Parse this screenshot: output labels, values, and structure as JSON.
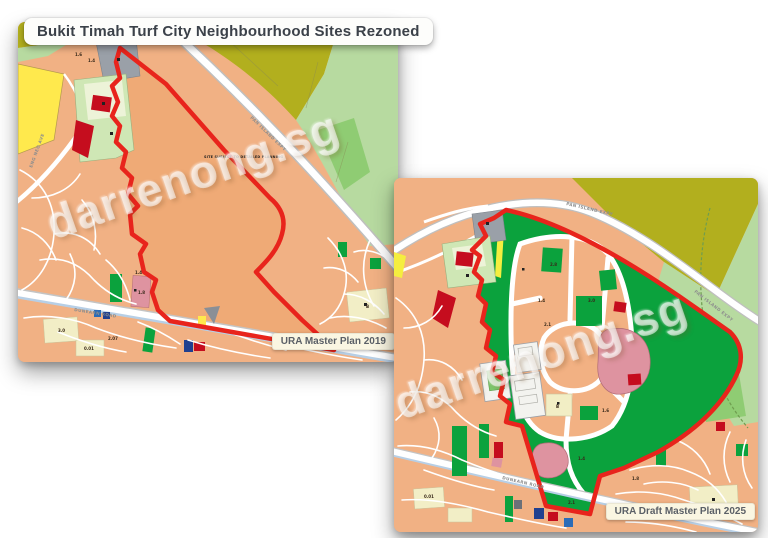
{
  "title": {
    "text": "Bukit Timah Turf City Neighbourhood Sites Rezoned"
  },
  "watermark": {
    "text": "darrenong.sg"
  },
  "panels": [
    {
      "caption": "URA Master Plan 2019"
    },
    {
      "caption": "URA Draft Master Plan 2025"
    }
  ],
  "map1": {
    "site_note": "SITE SUBJECT TO DETAILED PLANNING",
    "road_labels": [
      {
        "text": "PAN ISLAND EXPY"
      },
      {
        "text": "DUNEARN ROAD"
      },
      {
        "text": "ENG NEO AVE"
      }
    ],
    "parcel_labels": [
      {
        "text": "1.6"
      },
      {
        "text": "1.4"
      },
      {
        "text": "1.4"
      },
      {
        "text": "3.0"
      },
      {
        "text": "1.8"
      },
      {
        "text": "0.01"
      },
      {
        "text": "2.07"
      },
      {
        "text": "B"
      }
    ]
  },
  "map2": {
    "road_labels": [
      {
        "text": "PAN ISLAND EXPY"
      },
      {
        "text": "PAN ISLAND EXPY"
      },
      {
        "text": "DUNEARN ROAD"
      }
    ],
    "parcel_labels": [
      {
        "text": "2.8"
      },
      {
        "text": "1.4"
      },
      {
        "text": "3.0"
      },
      {
        "text": "2.1"
      },
      {
        "text": "1.6"
      },
      {
        "text": "1.4"
      },
      {
        "text": "2.1"
      },
      {
        "text": "1.8"
      },
      {
        "text": "0.01"
      },
      {
        "text": "B"
      }
    ]
  },
  "colors": {
    "boundary_red": "#e8241c",
    "park_green": "#0ba23d",
    "residential_peach": "#f1b184",
    "site_peach": "#efaa76",
    "olive_green": "#b2af1e",
    "pale_green": "#b7daa0",
    "mid_green": "#8fcc73",
    "civic_green": "#cfe7b5",
    "cream": "#f2eec6",
    "yellow": "#ffe94d",
    "pink": "#de93a0",
    "dark_red": "#c50d1e",
    "gray": "#9aa0a8",
    "navy": "#20408f",
    "rail_blue": "#b7cfe6"
  }
}
